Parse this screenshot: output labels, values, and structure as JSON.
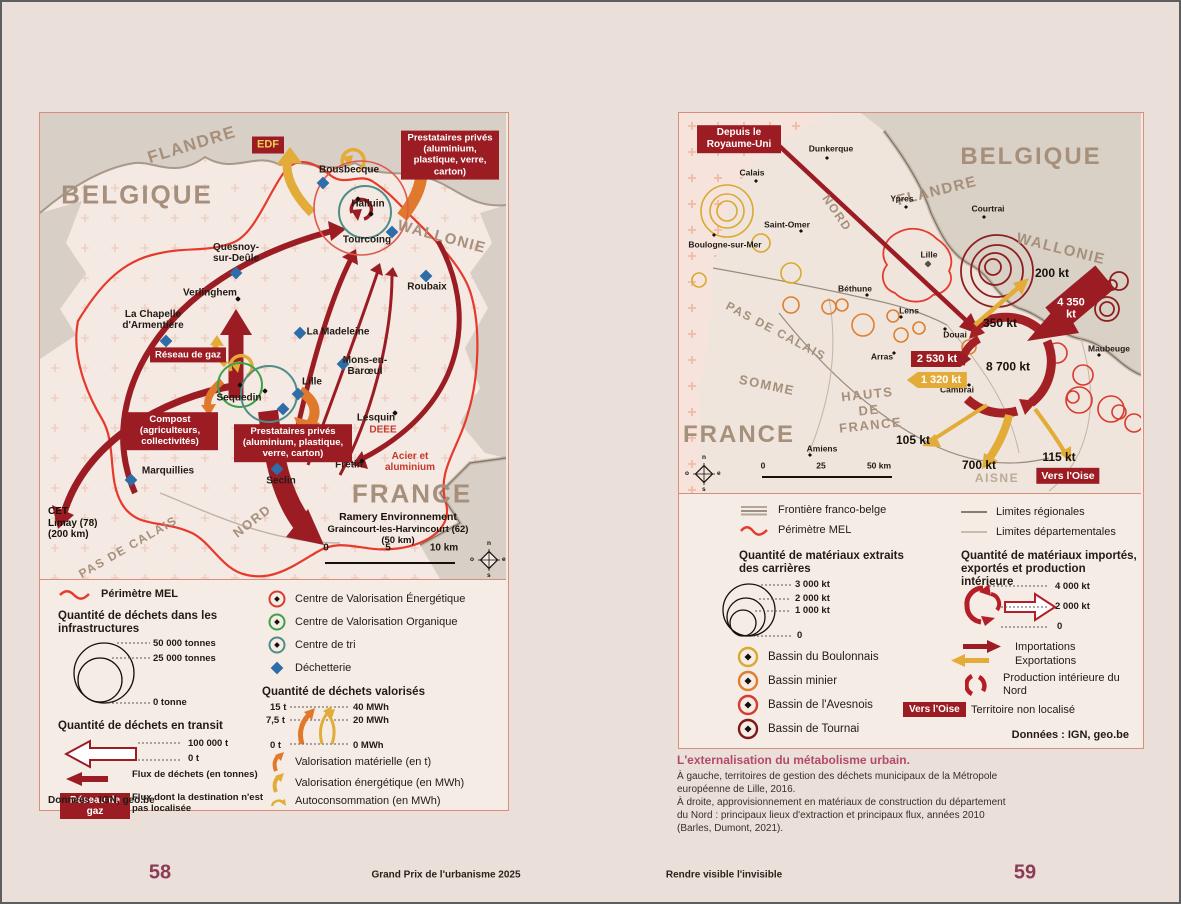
{
  "footer": {
    "page_left": "58",
    "section_left": "Grand Prix de l'urbanisme 2025",
    "section_right": "Rendre visible l'invisible",
    "page_right": "59"
  },
  "caption": {
    "title": "L'externalisation du métabolisme urbain.",
    "body1": "À gauche, territoires de gestion des déchets municipaux de la Métropole européenne de Lille, 2016.",
    "body2": "À droite, approvisionnement en matériaux de construction du département du Nord : principaux lieux d'extraction et principaux flux, années 2010 (Barles, Dumont, 2021)."
  },
  "left_map": {
    "regions": {
      "flandre": "FLANDRE",
      "belgique": "BELGIQUE",
      "wallonie": "WALLONIE",
      "france": "FRANCE",
      "nord": "NORD",
      "pas_de_calais": "PAS DE CALAIS"
    },
    "cities": {
      "bousbecque": "Bousbecque",
      "halluin": "Halluin",
      "tourcoing": "Tourcoing",
      "roubaix": "Roubaix",
      "quesnoy": "Quesnoy-sur-Deûle",
      "verlinghem": "Verlinghem",
      "la_chapelle": "La Chapelle d'Armentière",
      "la_madeleine": "La Madeleine",
      "mons_en_baroeul": "Mons-en-Barœul",
      "lille": "Lille",
      "sequedin": "Sequedin",
      "lesquin": "Lesquin",
      "marquillies": "Marquillies",
      "seclin": "Seclin",
      "fretin": "Frétin"
    },
    "badges": {
      "edf": "EDF",
      "prestataires_ne": "Prestataires privés (aluminium, plastique, verre, carton)",
      "reseau_de_gaz": "Réseau de gaz",
      "compost": "Compost (agriculteurs, collectivités)",
      "prestataires_centre": "Prestataires privés (aluminium, plastique, verre, carton)"
    },
    "annotations": {
      "deee": "DEEE",
      "acier": "Acier et aluminium",
      "cet": "CET",
      "cet_ville": "Limay (78)",
      "cet_dist": "(200 km)",
      "ramery": "Ramery Environnement",
      "ramery_ville": "Graincourt-les-Harvincourt (62)",
      "ramery_dist": "(50 km)"
    },
    "scale": {
      "t0": "0",
      "t1": "5",
      "t2": "10 km"
    },
    "compass": {
      "n": "n",
      "s": "s",
      "o": "o",
      "e": "e"
    }
  },
  "left_legend": {
    "perimetre": "Périmètre MEL",
    "infra_title": "Quantité de déchets dans les infrastructures",
    "infra_50": "50 000 tonnes",
    "infra_25": "25 000 tonnes",
    "infra_0": "0 tonne",
    "transit_title": "Quantité de déchets en transit",
    "transit_100": "100 000 t",
    "transit_0": "0 t",
    "flux": "Flux de déchets (en tonnes)",
    "reseau_badge": "Réseau de gaz",
    "flux_nl": "Flux dont la destination n'est pas localisée",
    "cve": "Centre de Valorisation Énergétique",
    "cvo": "Centre de Valorisation Organique",
    "tri": "Centre de tri",
    "dechetterie": "Déchetterie",
    "valo_title": "Quantité de déchets valorisés",
    "v15": "15 t",
    "v75": "7,5 t",
    "v0": "0 t",
    "mwh40": "40 MWh",
    "mwh20": "20 MWh",
    "mwh0": "0 MWh",
    "valo_mat": "Valorisation matérielle (en t)",
    "valo_en": "Valorisation énergétique (en MWh)",
    "autocons": "Autoconsommation (en MWh)",
    "source": "Données : IGN, geo.be"
  },
  "right_map": {
    "regions": {
      "belgique": "BELGIQUE",
      "flandre": "FLANDRE",
      "nord": "NORD",
      "wallonie": "WALLONIE",
      "pas_de_calais": "PAS DE CALAIS",
      "somme": "SOMME",
      "hauts_de_france": "HAUTS DE FRANCE",
      "france": "FRANCE",
      "aisne": "AISNE"
    },
    "cities": {
      "dunkerque": "Dunkerque",
      "calais": "Calais",
      "ypres": "Ypres",
      "courtrai": "Courtrai",
      "saint_omer": "Saint-Omer",
      "boulogne": "Boulogne-sur-Mer",
      "lille": "Lille",
      "bethune": "Béthune",
      "lens": "Lens",
      "douai": "Douai",
      "arras": "Arras",
      "cambrai": "Cambrai",
      "maubeuge": "Maubeuge",
      "amiens": "Amiens"
    },
    "flows": {
      "depuis_uk": "Depuis le Royaume-Uni",
      "kt200": "200 kt",
      "kt4350": "4 350 kt",
      "kt350": "350 kt",
      "kt2530": "2 530 kt",
      "kt8700": "8 700 kt",
      "kt1320": "1 320 kt",
      "kt105": "105 kt",
      "kt700": "700 kt",
      "kt115": "115 kt",
      "vers_oise": "Vers l'Oise"
    },
    "scale": {
      "t0": "0",
      "t1": "25",
      "t2": "50 km"
    },
    "compass": {
      "n": "n",
      "s": "s",
      "o": "o",
      "e": "e"
    }
  },
  "right_legend": {
    "frontiere": "Frontière franco-belge",
    "perimetre": "Périmètre MEL",
    "lim_reg": "Limites régionales",
    "lim_dep": "Limites départementales",
    "extr_title": "Quantité de matériaux extraits des carrières",
    "kt3000": "3 000 kt",
    "kt2000": "2 000 kt",
    "kt1000": "1 000 kt",
    "kt0": "0",
    "bassin_boulonnais": "Bassin du Boulonnais",
    "bassin_minier": "Bassin minier",
    "bassin_avesnois": "Bassin de l'Avesnois",
    "bassin_tournai": "Bassin de Tournai",
    "imp_title": "Quantité de matériaux importés, exportés et production intérieure",
    "ikt4000": "4 000 kt",
    "ikt2000": "2 000 kt",
    "ikt0": "0",
    "importations": "Importations",
    "exportations": "Exportations",
    "production": "Production intérieure du Nord",
    "vers_oise": "Vers l'Oise",
    "territoire": "Territoire non localisé",
    "source": "Données : IGN, geo.be"
  }
}
